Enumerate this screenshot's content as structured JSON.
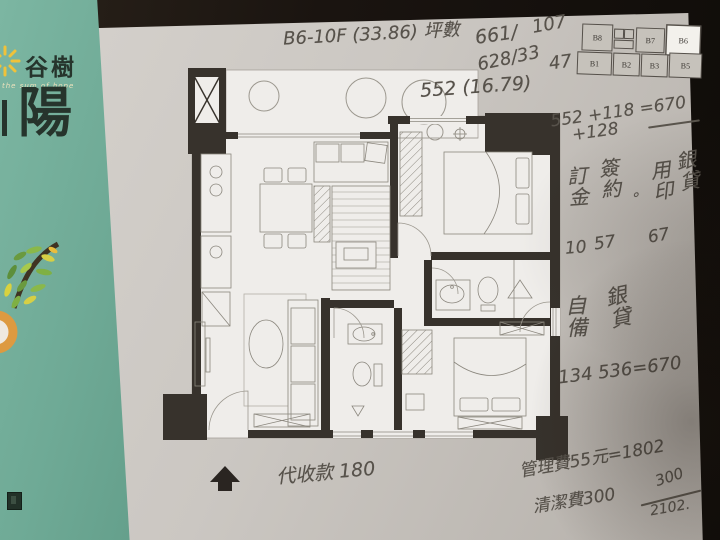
{
  "colors": {
    "brochure_green": "#6faa96",
    "paper_gray": "#cbc7c2",
    "ink_pencil": "#57524b",
    "plan_wall": "#37322c",
    "keyplan_highlight": "#f3f1ec"
  },
  "brochure": {
    "brand": "谷樹",
    "tagline": "the sum of hope",
    "big_char": "陽"
  },
  "keyplan": {
    "units": [
      "B8",
      "B7",
      "B6",
      "B1",
      "B2",
      "B3",
      "B5"
    ],
    "highlight_unit": "B6"
  },
  "annotations": {
    "unit_line": "B6-10F (33.86) 坪數",
    "num_a": "661/",
    "num_b": "107",
    "num_c": "628/33",
    "num_d": "47",
    "area_line": "552 (16.79)",
    "calc_top": "552 +118 =670",
    "calc_top2": "+128",
    "payment": {
      "deposit_label": "訂金",
      "contract_label": "簽約",
      "zero_mark": "。",
      "seal_label": "用印",
      "loan_label": "銀貸",
      "deposit_value": "10",
      "contract_value": "57",
      "seal_value": "67"
    },
    "self_fund": {
      "label": "自備",
      "loan_label": "銀貸",
      "calc": "134 536=670"
    },
    "collection": "代收款 180",
    "management_fee": "管理費55元=1802",
    "cleaning_fee": "清潔費300",
    "fraction_top": "300",
    "fraction_bottom": "2102."
  }
}
